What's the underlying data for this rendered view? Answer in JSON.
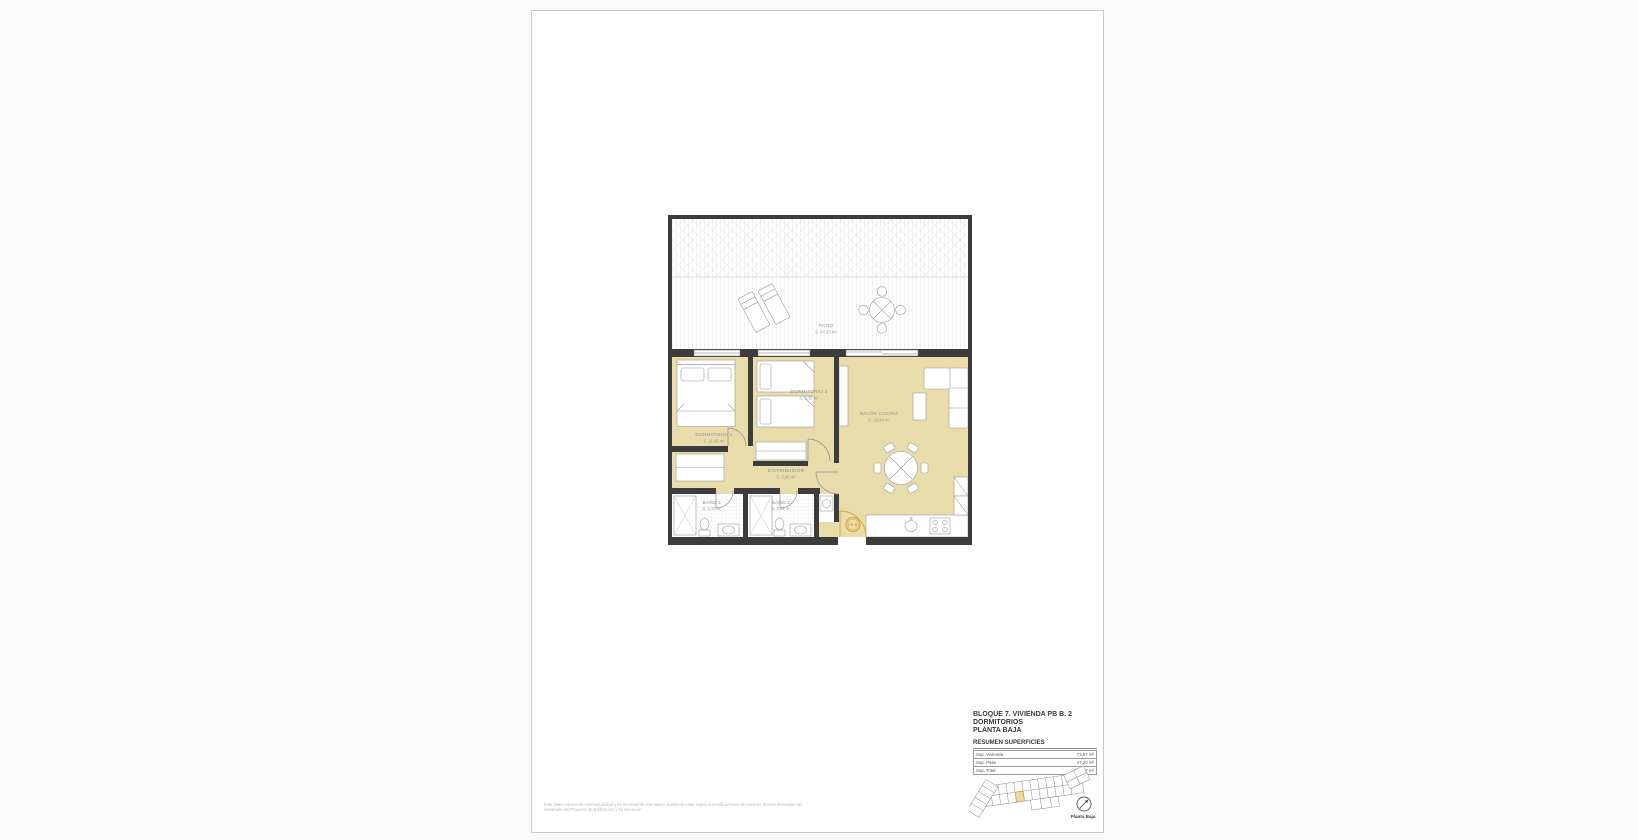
{
  "plan": {
    "rooms": [
      {
        "name": "PATIO",
        "area": "S. 47,20 m²"
      },
      {
        "name": "DORMITORIO 1",
        "area": "S. 11,95 m²"
      },
      {
        "name": "DORMITORIO 2",
        "area": "S. 9,35 m²"
      },
      {
        "name": "SALÓN-COCINA",
        "area": "S. 28,40 m²"
      },
      {
        "name": "DISTRIBUIDOR",
        "area": "S. 2,80 m²"
      },
      {
        "name": "BAÑO 1",
        "area": "S. 3,70 m²"
      },
      {
        "name": "BAÑO 2",
        "area": "S. 3,45 m²"
      }
    ],
    "entry_badge": "PB B"
  },
  "title_block": {
    "line1": "BLOQUE 7. VIVIENDA PB B. 2 DORMITORIOS",
    "line2": "PLANTA BAJA",
    "section": "RESUMEN SUPERFICIES",
    "rows": [
      {
        "label": "Sup. Vivienda",
        "value": "73,57 m²"
      },
      {
        "label": "Sup. Patio",
        "value": "47,20 m²"
      },
      {
        "label": "Sup. Total",
        "value": "120,77 m²"
      }
    ],
    "keyplan_caption": "Planta Baja"
  },
  "footer": {
    "disclaimer_line1": "Este plano carece de contractualidad y es meramente orientativo, pudiendo estar sujeto a modificaciones de carácter técnico derivadas del",
    "disclaimer_line2": "desarrollo del Proyecto de Edificación y su ejecución."
  },
  "colors": {
    "room_fill": "#e9dcab",
    "accent_orange": "#d9a337",
    "wall": "#3c3c3c",
    "furniture_stroke": "#9a9a9a"
  }
}
